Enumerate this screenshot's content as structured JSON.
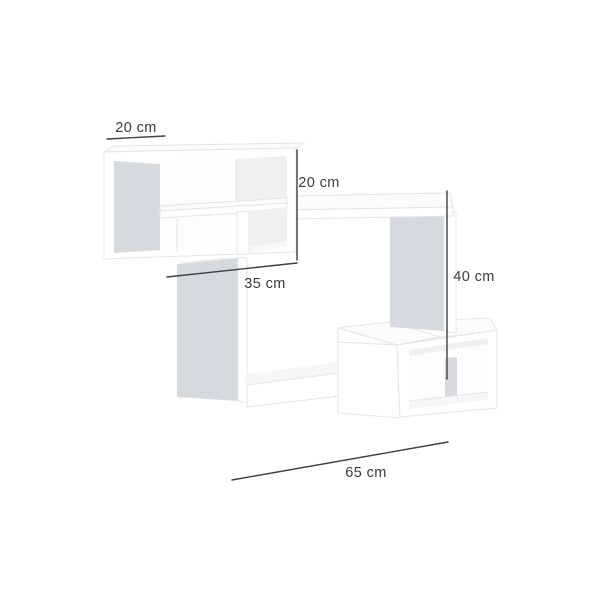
{
  "diagram": {
    "unit": "cm",
    "dimensions": {
      "top_depth": {
        "label": "20 cm",
        "value": 20,
        "measures": "depth of upper box (top-left slanted line)"
      },
      "top_height": {
        "label": "20 cm",
        "value": 20,
        "measures": "height of upper box (vertical line)"
      },
      "top_width": {
        "label": "35 cm",
        "value": 35,
        "measures": "width of upper box (slanted line below box)"
      },
      "main_height": {
        "label": "40 cm",
        "value": 40,
        "measures": "height of main frame (right vertical line)"
      },
      "main_width": {
        "label": "65 cm",
        "value": 65,
        "measures": "overall width (bottom slanted line)"
      }
    },
    "colors": {
      "background": "#ffffff",
      "panel_white": "#ffffff",
      "panel_edge": "#e3e5e7",
      "face_shadow_gray": "#d7dadc",
      "face_soft_gray": "#eef0f2",
      "face_faint": "#f6f7f8",
      "dim_line": "#3f4142",
      "dim_text": "#3a3c3e"
    }
  }
}
